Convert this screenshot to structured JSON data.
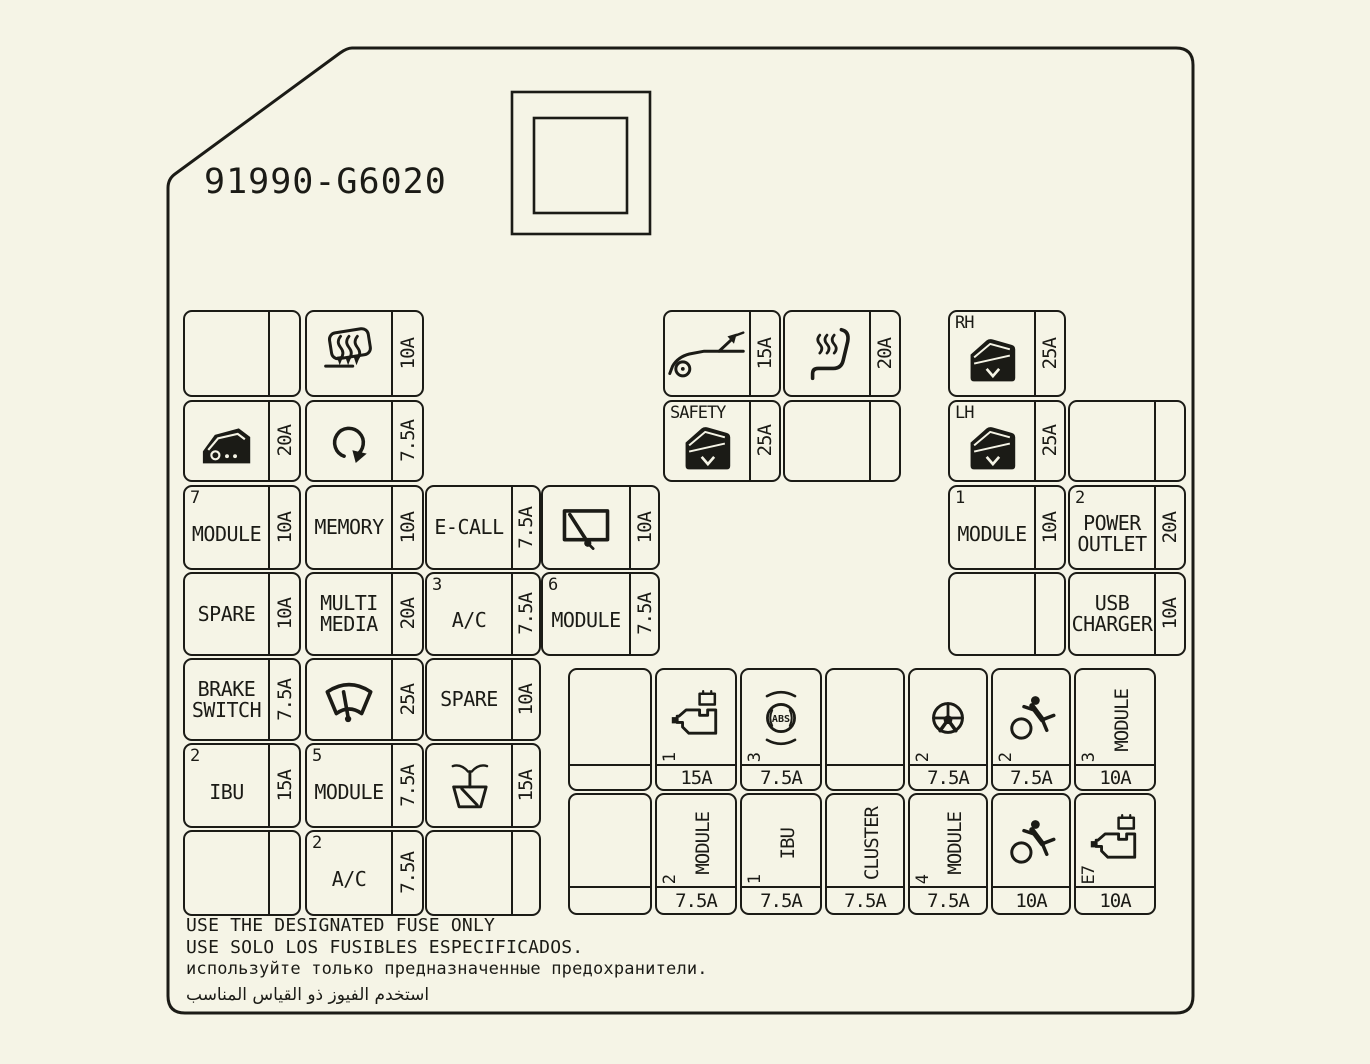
{
  "part_number": "91990-G6020",
  "colors": {
    "background": "#f5f4e6",
    "line": "#1b1b16"
  },
  "icon_labels": {
    "abs": "ABS"
  },
  "footer": {
    "line1": "USE THE DESIGNATED FUSE ONLY",
    "line2": "USE SOLO LOS FUSIBLES ESPECIFICADOS.",
    "line3": "используйте только предназначенные предохранители.",
    "line4": "استخدم الفيوز ذو القياس المناسب"
  },
  "blocks": {
    "left": {
      "rows": [
        [
          {
            "amp": ""
          },
          {
            "icon": "defroster-icon",
            "amp": "10A"
          }
        ],
        [
          {
            "icon": "door-lock-icon",
            "amp": "20A"
          },
          {
            "icon": "loop-arrow-icon",
            "amp": "7.5A"
          }
        ],
        [
          {
            "index": "7",
            "label": "MODULE",
            "amp": "10A"
          },
          {
            "label": "MEMORY",
            "amp": "10A"
          },
          {
            "label": "E-CALL",
            "amp": "7.5A"
          },
          {
            "icon": "rear-wiper-icon",
            "amp": "10A"
          }
        ],
        [
          {
            "label": "SPARE",
            "amp": "10A"
          },
          {
            "lines": [
              "MULTI",
              "MEDIA"
            ],
            "amp": "20A"
          },
          {
            "index": "3",
            "label": "A/C",
            "amp": "7.5A"
          },
          {
            "index": "6",
            "label": "MODULE",
            "amp": "7.5A"
          }
        ],
        [
          {
            "lines": [
              "BRAKE",
              "SWITCH"
            ],
            "amp": "7.5A"
          },
          {
            "icon": "front-wiper-icon",
            "amp": "25A"
          },
          {
            "label": "SPARE",
            "amp": "10A"
          }
        ],
        [
          {
            "index": "2",
            "label": "IBU",
            "amp": "15A"
          },
          {
            "index": "5",
            "label": "MODULE",
            "amp": "7.5A"
          },
          {
            "icon": "washer-icon",
            "amp": "15A"
          }
        ],
        [
          {
            "amp": ""
          },
          {
            "index": "2",
            "label": "A/C",
            "amp": "7.5A"
          },
          {
            "amp": ""
          }
        ]
      ]
    },
    "mid": {
      "rows": [
        [
          {
            "icon": "trunk-open-icon",
            "amp": "15A"
          },
          {
            "icon": "heated-seat-icon",
            "amp": "20A"
          }
        ],
        [
          {
            "index": "SAFETY",
            "icon": "power-window-icon",
            "amp": "25A"
          },
          {
            "amp": ""
          }
        ]
      ]
    },
    "right": {
      "rows": [
        [
          {
            "index": "RH",
            "icon": "power-window-icon",
            "amp": "25A"
          },
          null
        ],
        [
          {
            "index": "LH",
            "icon": "power-window-icon",
            "amp": "25A"
          },
          {
            "amp": ""
          }
        ],
        [
          {
            "index": "1",
            "label": "MODULE",
            "amp": "10A"
          },
          {
            "index": "2",
            "lines": [
              "POWER",
              "OUTLET"
            ],
            "amp": "20A"
          }
        ],
        [
          {
            "amp": ""
          },
          {
            "lines": [
              "USB",
              "CHARGER"
            ],
            "amp": "10A"
          }
        ]
      ]
    },
    "grid": {
      "rows": [
        [
          {},
          {
            "icon": "engine-icon",
            "index": "1",
            "amp": "15A"
          },
          {
            "icon": "abs-icon",
            "index": "3",
            "amp": "7.5A"
          },
          {},
          {
            "icon": "steering-icon",
            "index": "2",
            "amp": "7.5A"
          },
          {
            "icon": "airbag-icon",
            "index": "2",
            "amp": "7.5A"
          },
          {
            "vlabel": "MODULE",
            "index": "3",
            "amp": "10A"
          }
        ],
        [
          {},
          {
            "vlabel": "MODULE",
            "index": "2",
            "amp": "7.5A"
          },
          {
            "vlabel": "IBU",
            "index": "1",
            "amp": "7.5A"
          },
          {
            "vlabel": "CLUSTER",
            "amp": "7.5A"
          },
          {
            "vlabel": "MODULE",
            "index": "4",
            "amp": "7.5A"
          },
          {
            "icon": "airbag-icon",
            "amp": "10A"
          },
          {
            "icon": "engine-icon",
            "index": "E7",
            "amp": "10A"
          }
        ]
      ]
    }
  }
}
